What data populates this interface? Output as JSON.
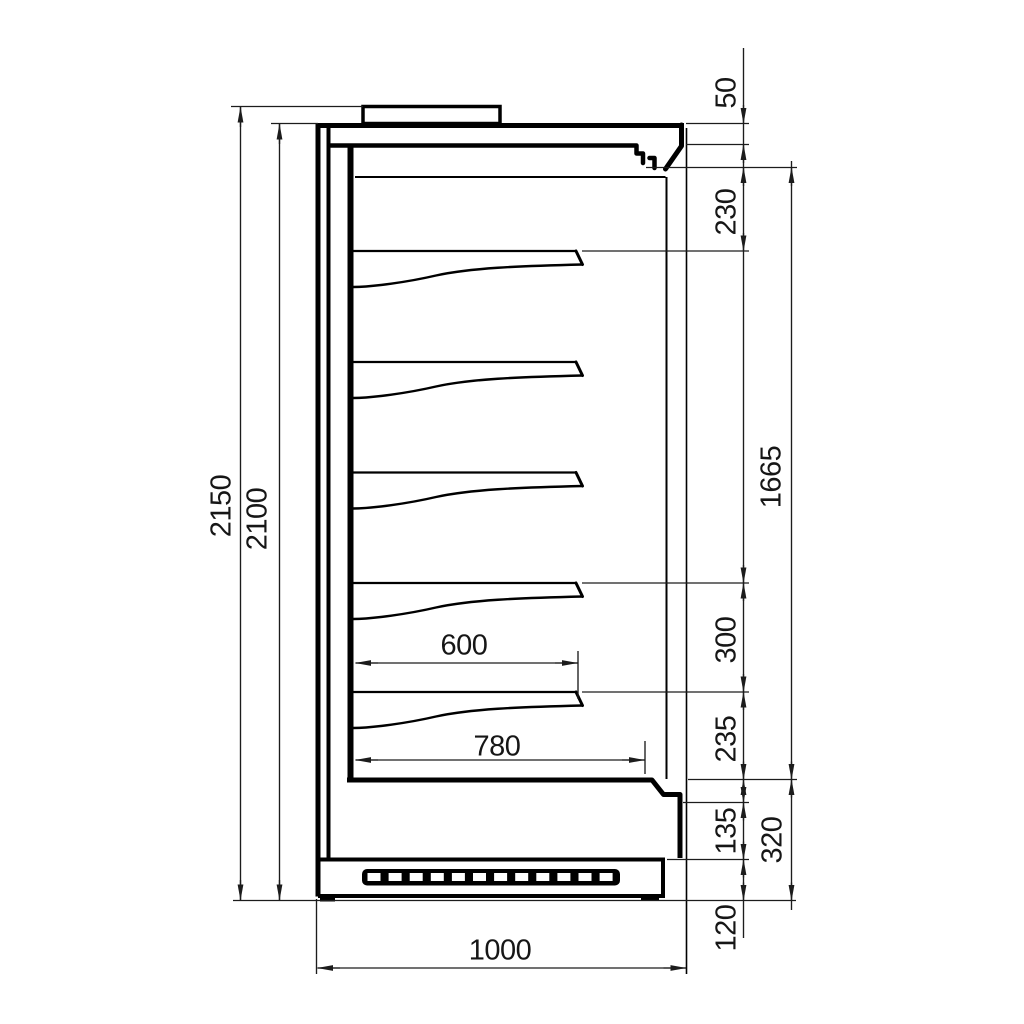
{
  "figure": {
    "description": "Black-and-white technical side-section drawing of a vertical multideck display cabinet with 5 shelves, canopy air-duct nozzle, front glass, base grille and dimension lines",
    "shelves_shown": 5,
    "grille_slots": 12,
    "line_color": "#000000",
    "dimension_line_color": "#1c1c1c",
    "background_color": "#ffffff"
  },
  "dimensions": {
    "overall_height": "2150",
    "cabinet_height": "2100",
    "canopy_top": "50",
    "canopy_to_first_shelf": "230",
    "display_opening_height": "1665",
    "shelf_pitch": "300",
    "last_shelf_to_deck": "235",
    "front_panel_height": "135",
    "base_section_height": "320",
    "plinth_height": "120",
    "shelf_depth": "600",
    "deck_depth": "780",
    "overall_depth": "1000"
  }
}
